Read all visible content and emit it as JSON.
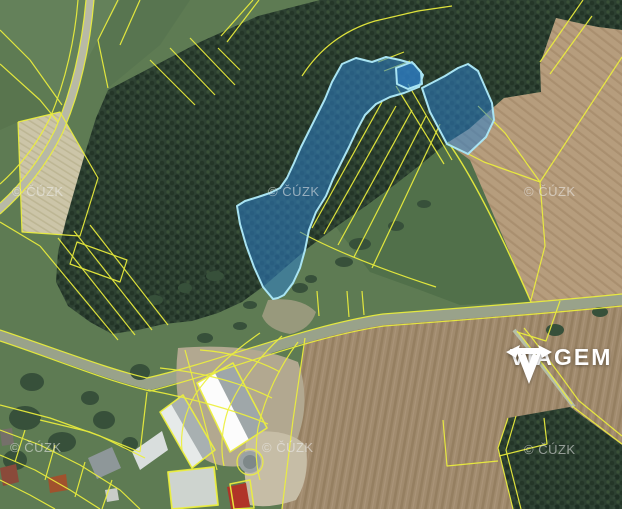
{
  "app": {
    "type": "real-estate-aerial-cadastral-map",
    "description": "Orthophoto map with cadastral parcel boundaries and highlighted parcels for sale"
  },
  "map": {
    "watermark": {
      "text": "© ČÚZK",
      "count": 6
    },
    "highlighted_parcels": {
      "count": 3,
      "fill": "#2e7fc8",
      "fill_opacity": 0.55,
      "border": "#a9e4f3"
    },
    "cadastral_line_color": "#edf03c",
    "terrain_colors": {
      "forest": "#2d4132",
      "meadow": "#5e7b53",
      "plowed_field_brown": "#a18b6e",
      "tan_field": "#b69d7d",
      "pale_field": "#ccc5a8",
      "road": "#99a28a"
    }
  },
  "brand": {
    "name": "VIAGEM",
    "color": "#ffffff"
  }
}
